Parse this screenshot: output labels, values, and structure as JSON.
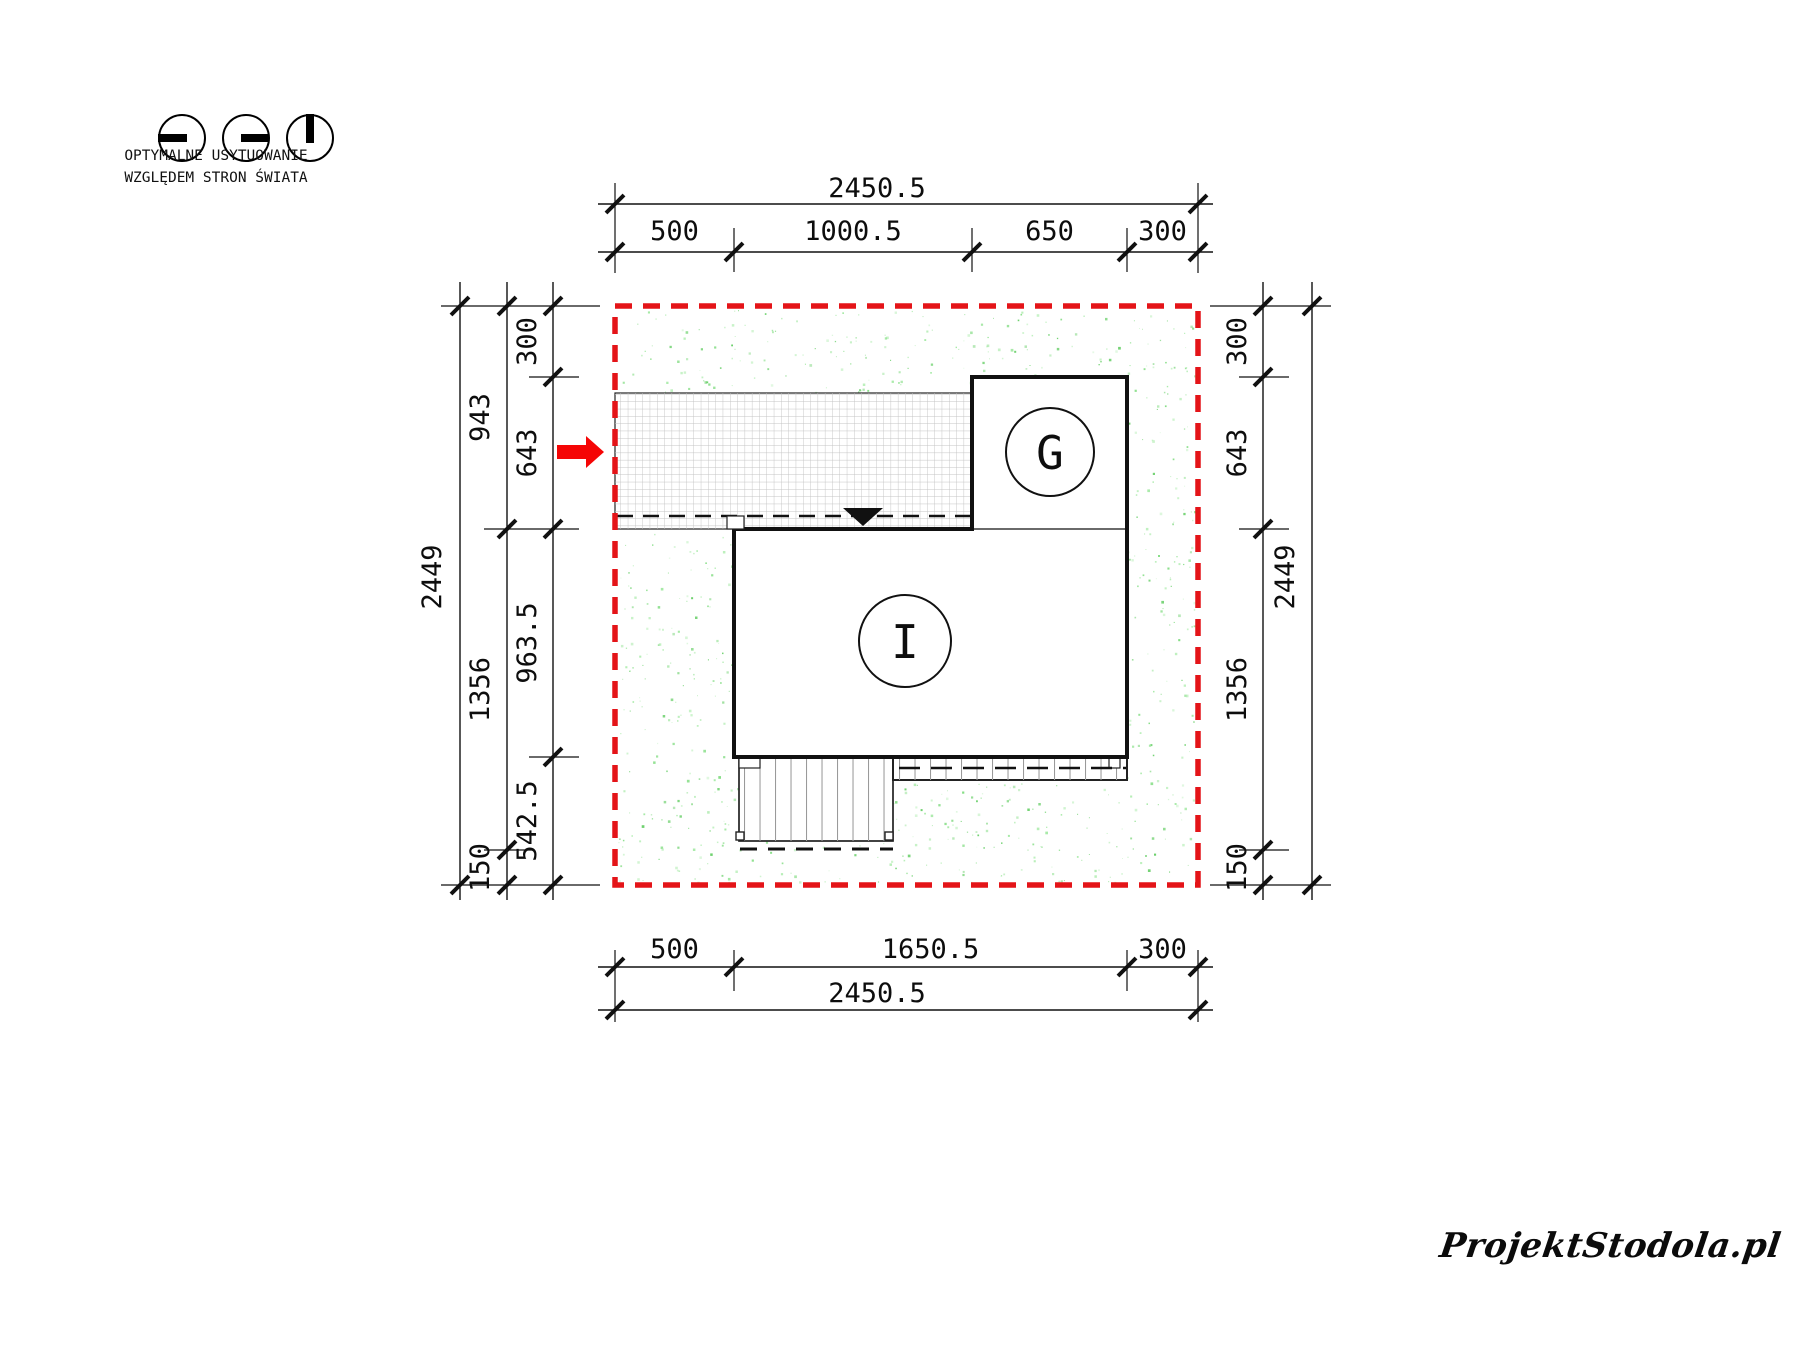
{
  "legend": {
    "icons": [
      "sun-dial-west-icon",
      "sun-dial-east-icon",
      "sun-dial-north-icon"
    ],
    "line1": "OPTYMALNE USYTUOWANIE",
    "line2": "WZGLĘDEM STRON ŚWIATA"
  },
  "plan": {
    "garage_label": "G",
    "house_label": "I"
  },
  "dimensions": {
    "top": {
      "total": "2450.5",
      "segments": [
        "500",
        "1000.5",
        "650",
        "300"
      ]
    },
    "bottom": {
      "total": "2450.5",
      "segments": [
        "500",
        "1650.5",
        "300"
      ]
    },
    "left": {
      "total": "2449",
      "middle_segments": [
        "943",
        "1356",
        "150"
      ],
      "inner_segments": [
        "300",
        "643",
        "963.5",
        "542.5"
      ]
    },
    "right": {
      "total": "2449",
      "inner_segments": [
        "300",
        "643",
        "1356",
        "150"
      ]
    }
  },
  "watermark": "ProjektStodola.pl",
  "colors": {
    "plot_boundary": "#e41418",
    "arrow": "#f50505",
    "ink": "#111111",
    "grass_speckles": [
      "#79da79",
      "#97e697",
      "#5bcb5b",
      "#b4eeb4"
    ],
    "grid_line": "#c3c3c3",
    "plank_line": "#9a9a9a"
  }
}
